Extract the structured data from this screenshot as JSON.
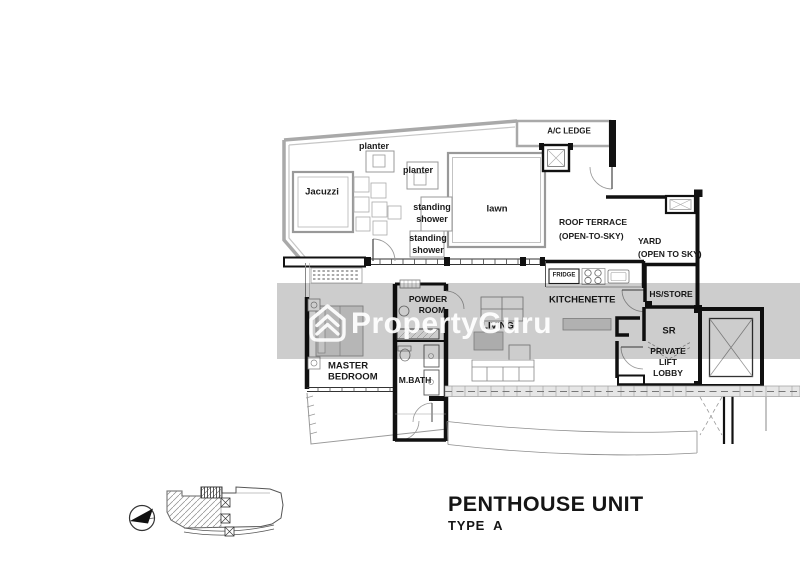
{
  "watermark": {
    "brand": "PropertyGuru",
    "band_color": "#cdcdcd",
    "text_color": "#ffffff"
  },
  "title": {
    "main": "PENTHOUSE UNIT",
    "sub": "TYPE A"
  },
  "plan": {
    "labels": {
      "planter_a": "planter",
      "planter_b": "planter",
      "jacuzzi": "Jacuzzi",
      "shower_a1": "standing",
      "shower_a2": "shower",
      "shower_b1": "standing",
      "shower_b2": "shower",
      "lawn": "lawn",
      "ac_ledge": "A/C LEDGE",
      "roof_terrace_1": "ROOF TERRACE",
      "roof_terrace_2": "(OPEN-TO-SKY)",
      "yard_1": "YARD",
      "yard_2": "(OPEN TO SKY)",
      "fridge": "FRIDGE",
      "kitchenette": "KITCHENETTE",
      "hs_store": "HS/STORE",
      "sr": "SR",
      "lobby_1": "PRIVATE",
      "lobby_2": "LIFT",
      "lobby_3": "LOBBY",
      "powder_1": "POWDER",
      "powder_2": "ROOM",
      "living": "LIVING",
      "master_1": "MASTER",
      "master_2": "BEDROOM",
      "mbath": "M.BATH"
    }
  }
}
